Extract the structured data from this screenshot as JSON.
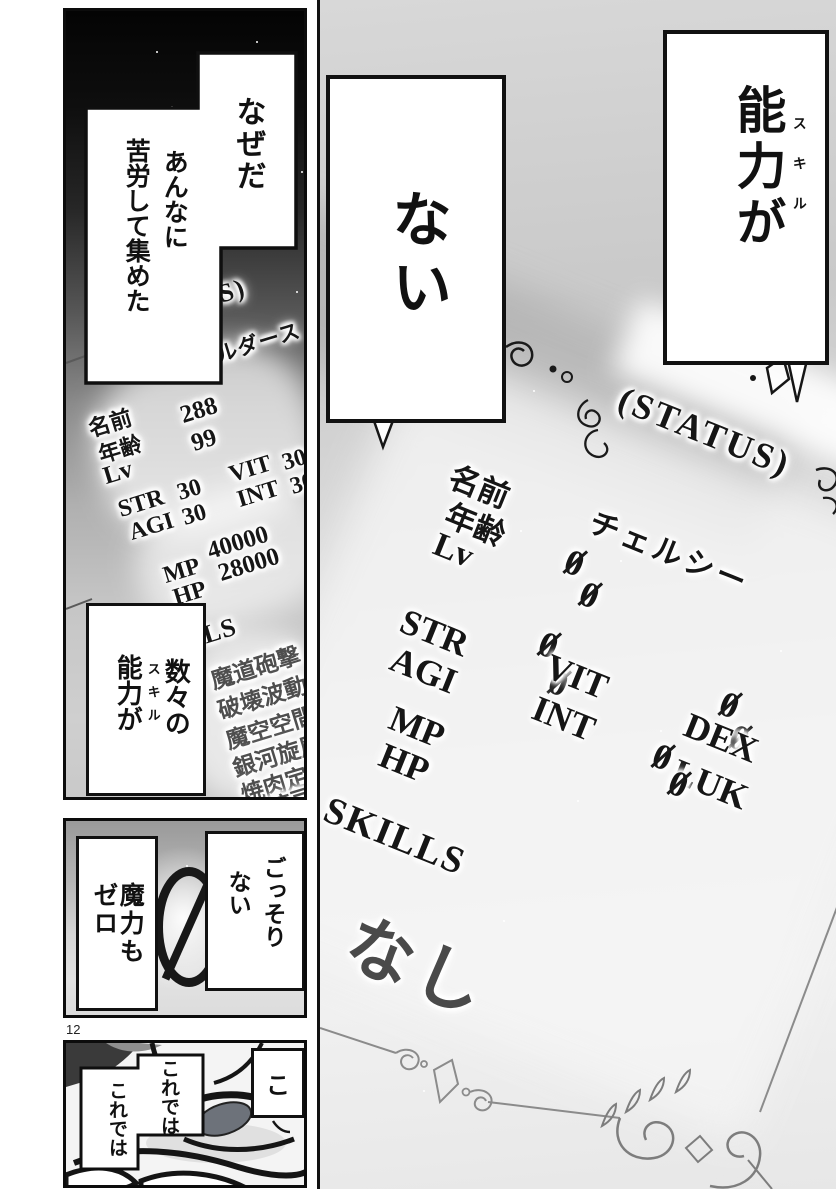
{
  "page": {
    "number": "12"
  },
  "right_panel": {
    "box_skill": {
      "text": "能力が",
      "furigana": "スキル"
    },
    "box_nai": {
      "text": "ない"
    },
    "status": {
      "title": "(STATUS)",
      "name_label": "名前",
      "name_value": "チェルシー",
      "age_label": "年齢",
      "age_value": "0",
      "level_label": "Lv",
      "level_value": "0",
      "stats": [
        {
          "label": "STR",
          "value": "0"
        },
        {
          "label": "AGI",
          "value": "0"
        },
        {
          "label": "VIT",
          "value": "0"
        },
        {
          "label": "INT",
          "value": "0"
        },
        {
          "label": "DEX",
          "value": "0"
        },
        {
          "label": "LUK",
          "value": "0"
        },
        {
          "label": "MP",
          "value": "0"
        },
        {
          "label": "HP",
          "value": "0"
        }
      ],
      "skills_label": "SKILLS",
      "skills_value": "なし"
    }
  },
  "left_panel": {
    "bubble_naze": {
      "col1": "なぜだ",
      "col2": "あんなに",
      "col3": "苦労して集めた"
    },
    "status": {
      "title": "(STATUS)",
      "name_label": "名前",
      "name_value": "ヴェルダース",
      "age_label": "年齢",
      "age_value": "288",
      "level_label": "Lv",
      "level_value": "99",
      "stats": [
        {
          "label": "STR",
          "value": "30"
        },
        {
          "label": "AGI",
          "value": "30"
        },
        {
          "label": "VIT",
          "value": "30"
        },
        {
          "label": "INT",
          "value": "30"
        },
        {
          "label": "MP",
          "value": "40000"
        },
        {
          "label": "HP",
          "value": "28000"
        }
      ],
      "skills_label": "SKILLS",
      "skills": [
        "魔道砲撃",
        "破壊波動",
        "魔空空間",
        "銀河旋風",
        "焼肉定",
        "渡豆"
      ]
    },
    "bubble_kazu": {
      "col1": "数々の",
      "col2": "能力が",
      "furigana": "スキル"
    }
  },
  "middle_panel": {
    "box_maryoku": {
      "text": "魔力もゼロ"
    },
    "zero": "0",
    "box_gossori": {
      "col1": "ごっそり",
      "col2": "ない"
    }
  },
  "bottom_panel": {
    "bubble_korede": {
      "col1": "これでは",
      "col2": "これでは"
    },
    "box_ko": {
      "text": "こ"
    }
  }
}
